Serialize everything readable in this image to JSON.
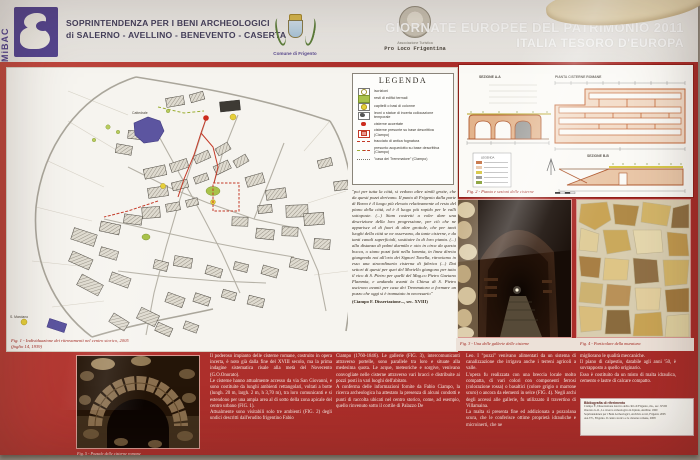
{
  "header": {
    "mibac": "MiBAC",
    "soprintendenza_line1": "SOPRINTENDENZA PER I BENI ARCHEOLOGICI",
    "soprintendenza_line2": "di SALERNO - AVELLINO - BENEVENTO - CASERTA",
    "comune_label": "Comune di Frigento",
    "proloco_line1": "Associazione Turistica",
    "proloco_line2": "Pro Loco Frigentina"
  },
  "event": {
    "line1": "GIORNATE EUROPEE DEL PATRIMONIO 2011",
    "line2": "ITALIA TESORO D'EUROPA"
  },
  "legend": {
    "title": "LEGENDA",
    "items": [
      "iscrizioni",
      "resti di edifici termali",
      "capitelli o basi di colonne",
      "leoni o statue di incerta collocazione temporale",
      "cisterne accertate",
      "cisterne presunte su base descrittiva (Ciampo)",
      "tracciato di antica fognatura",
      "presunto acquedotto su base descrittiva (Ciampo)",
      "\"casa dei Tremmatore\" (Ciampo)"
    ],
    "quote": "\"poi per tutta la città, si vedono altre simili grotte, che da questi pozzi derivano. Il punto di Frigento dalla parte di Borea è il luogo più elevato relativamente al resto del piano della città, ed è il luogo più rapido per le valli sottoposte. (...) Siam costretti a voler dare una descrizione della loro progressione, per ciò che ne apparisce al di fuori di altre grottole, che per tanti luoghi della città se ne osservano, da tante cisterne, e da tanti canali superficiali, sostituire la di loro pianta. (...) alla distanza di palmi duemila e otto in circa da questa bocca, o siano pozzi fatti nella lommia, in linea diretta giungendo noi all'orto dei Signori Tonella, ritroviamo in esso una straordinaria cisterna di fabrica (...) Dai settori di questi per quei del Moriello giungono per tutto il vico di S. Pietro per quelli del Mag.co Pietro Gaetano Flammia, e andando avanti la Chiesa di S. Pietro uscirono avanti per casa dei Tremmatora a formare un pozzo che oggi si è tramutato in necessario\"",
    "source": "(Ciampo F. Dissertazione..., sec. XVIII)"
  },
  "map": {
    "label_cattedrale": "Cattedrale",
    "label_s_marciano": "S. Marciano",
    "caption1": "Fig. 1 - Individuazione dei ritrovamenti nel centro storico, 2005",
    "caption2": "(foglio 14, 1939)"
  },
  "fig2": {
    "sezione_a": "SEZIONE A-A",
    "pianta": "PIANTA CISTERNE ROMANE",
    "sezione_b": "SEZIONE B-B",
    "mini_legend": "LEGENDA",
    "caption": "Fig. 2 - Pianta e sezioni delle cisterne"
  },
  "fig3": {
    "caption": "Fig. 3 - Una delle gallerie delle cisterne"
  },
  "fig4": {
    "caption": "Fig. 4 - Particolare della muratura"
  },
  "fig5": {
    "caption": "Fig. 5 - Pozzale delle cisterne romane"
  },
  "article": {
    "col1": "Il poderoso impianto delle cisterne romane, costruito in opera incerta, è noto già dalla fine del XVIII secolo, ma la prima indagine sistematica risale alla metà del Novecento (G.O.Onorato).\nLe cisterne hanno attualmente accesso da via San Giovanni, e sono costituite da lunghi ambienti rettangolari, voltati a botte (lungh. 20 m, largh. 2 m, h 3,70 m), tra loro comunicanti e si estendono per una ampia area al di sotto della zona apicale del centro urbano (FIG. 1).\nAttualmente sono visitabili solo tre ambienti (FIG. 2) degli undici descritti dall'erudito frigentino Fabio",
    "col2": "Ciampo (1760-1846). Le gallerie (FIG. 3), intercomunicanti attraverso portelle, sono parallele tra loro e situate alla medesima quota. Le acque, meteoriche e sorgive, venivano convogliate nelle cisterne attraverso vari bracci e distribuite ai pozzi posti in vari luoghi dell'abitato.\nA conferma delle informazioni fornite da Fabio Ciampo, la ricerca archeologica ha attestato la presenza di alcuni condotti e punti di raccolta ubicati nel centro storico, come, ad esempio, quello rinvenuto sotto il cortile di Palazzo De",
    "col3": "Leo. I \"pozzi\" venivano alimentati da un sistema di canalizzazione che irrigava anche i terreni agricoli a valle.\nL'opera fu realizzata con una breccia locale molto compatta, di vari colori con componenti ferrosi (colorazione rossa) o basaltici (colore grigio o marrone scuro) o ancora da elementi in selce (FIG. 4). Negli archi degli accessi alle gallerie, fu utilizzato il travertino di Villamaina.\nLa malta si presenta fine ed addizionata a pozzolana scura, che le conferisce ottime proprietà idrauliche e microinerti, che ne",
    "col4": "migliorano le qualità meccaniche.\nIl piano di calpestio, databile agli anni '50, è sovrapposto a quello originario.\nEsso è costituito da un misto di malta idraulica, cemento e lastre di calcare compatto.",
    "biblio_title": "Bibliografia di riferimento",
    "biblio_lines": [
      "Ciampo F., Dissertazione istorica della città di Frigento, ms., sec. XVIII",
      "Onorato G.O., La ricerca archeologica in Irpinia, Avellino 1960",
      "Soprintendenza per i Beni Archeologici, Archivio scavi, Frigento 2005",
      "AA.VV., Frigento. Il centro storico e le cisterne romane, 2008"
    ]
  },
  "colors": {
    "frame_red": "#ad2f2b",
    "caption_red": "#a0231b",
    "mibac_purple": "#55458f",
    "plan_orange": "#c4693a"
  }
}
